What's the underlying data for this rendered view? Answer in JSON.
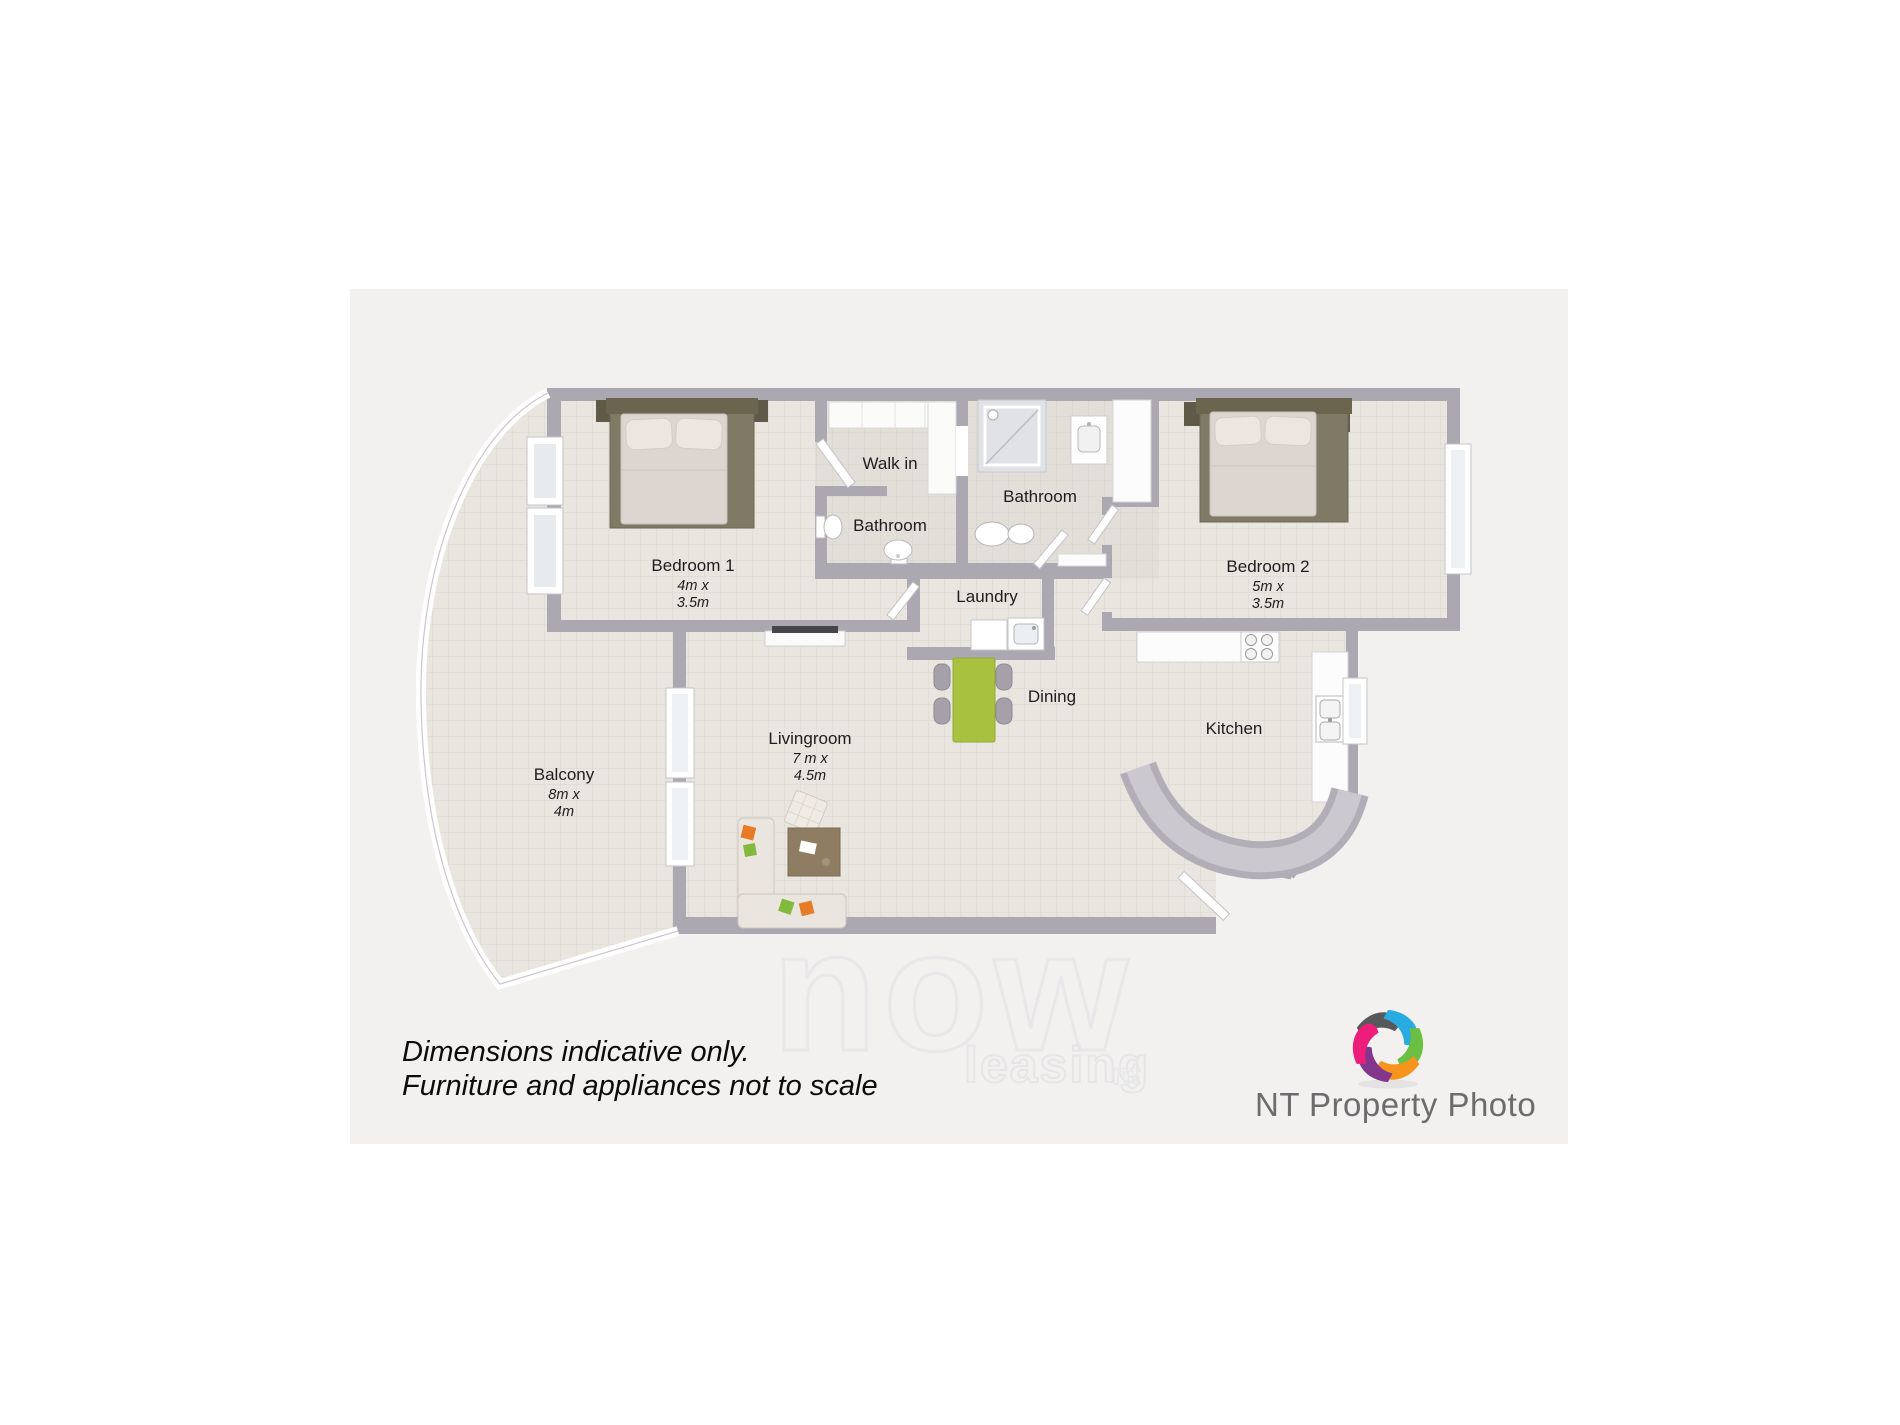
{
  "image_type": "3d-floor-plan",
  "palette": {
    "background": "#ffffff",
    "canvas": "#f2f1ef",
    "floor_tile": "#e9e6df",
    "tile_grid": "#dbd7cf",
    "wall": "#aca8b1",
    "furniture_frame_olive": "#7f7965",
    "mattress": "#ddd6d0",
    "dining_table_green": "#a8c13f",
    "accent_orange": "#e87b25",
    "accent_green": "#84b93f",
    "coffee_table_brown": "#8e7d63",
    "label_text": "#1d1d1f",
    "watermark_outline": "#e8e7e9",
    "logo_text_gray": "#6c6c6f"
  },
  "floorplan": {
    "rooms": [
      {
        "id": "bedroom1",
        "label": "Bedroom 1",
        "dims": "4m x\n3.5m"
      },
      {
        "id": "walkin",
        "label": "Walk in",
        "dims": ""
      },
      {
        "id": "bathroom1",
        "label": "Bathroom",
        "dims": ""
      },
      {
        "id": "bathroom2",
        "label": "Bathroom",
        "dims": ""
      },
      {
        "id": "laundry",
        "label": "Laundry",
        "dims": ""
      },
      {
        "id": "bedroom2",
        "label": "Bedroom 2",
        "dims": "5m x\n3.5m"
      },
      {
        "id": "dining",
        "label": "Dining",
        "dims": ""
      },
      {
        "id": "kitchen",
        "label": "Kitchen",
        "dims": ""
      },
      {
        "id": "livingroom",
        "label": "Livingroom",
        "dims": "7 m x\n4.5m"
      },
      {
        "id": "balcony",
        "label": "Balcony",
        "dims": "8m x\n4m"
      }
    ]
  },
  "disclaimer": {
    "line1": "Dimensions indicative only.",
    "line2": "Furniture and appliances not to scale"
  },
  "watermark": {
    "word": "now",
    "sub": "leasing",
    "suffix": "nt"
  },
  "logo": {
    "name": "NT Property Photo",
    "icon_colors": [
      "#58595b",
      "#29abe2",
      "#6abf44",
      "#f7941e",
      "#82368c",
      "#ec1e79"
    ]
  }
}
